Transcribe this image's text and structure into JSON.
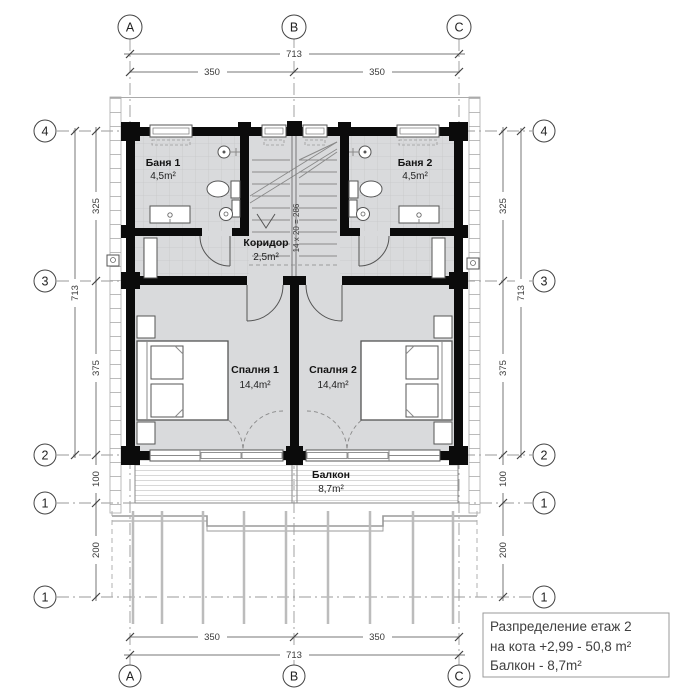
{
  "grid": {
    "top": [
      "A",
      "B",
      "C"
    ],
    "bottom": [
      "A",
      "B",
      "C"
    ],
    "left": [
      "4",
      "3",
      "2",
      "1",
      "1"
    ],
    "right": [
      "4",
      "3",
      "2",
      "1",
      "1"
    ]
  },
  "dims": {
    "top_total": "713",
    "top": [
      "350",
      "350"
    ],
    "bottom": [
      "350",
      "350"
    ],
    "bottom_total": "713",
    "left": [
      "325",
      "375",
      "100",
      "200"
    ],
    "left_total": "713",
    "right": [
      "325",
      "375",
      "100",
      "200"
    ],
    "right_total": "713"
  },
  "rooms": {
    "bath1": {
      "name": "Баня 1",
      "area": "4,5m²"
    },
    "bath2": {
      "name": "Баня 2",
      "area": "4,5m²"
    },
    "corridor": {
      "name": "Коридор",
      "area": "2,5m²"
    },
    "bedroom1": {
      "name": "Спалня 1",
      "area": "14,4m²"
    },
    "bedroom2": {
      "name": "Спалня 2",
      "area": "14,4m²"
    },
    "balcony": {
      "name": "Балкон",
      "area": "8,7m²"
    }
  },
  "stairs": {
    "label": "14 x 20 = 286"
  },
  "title_block": {
    "line1": "Разпределение етаж 2",
    "line2": "на кота  +2,99 - 50,8 m²",
    "line3": "Балкон - 8,7m²"
  },
  "colors": {
    "wall": "#0b0b0b",
    "floor": "#d9dadc",
    "dim_line": "#777777",
    "dim_text": "#3a3a3a",
    "grid_line": "#999999"
  }
}
